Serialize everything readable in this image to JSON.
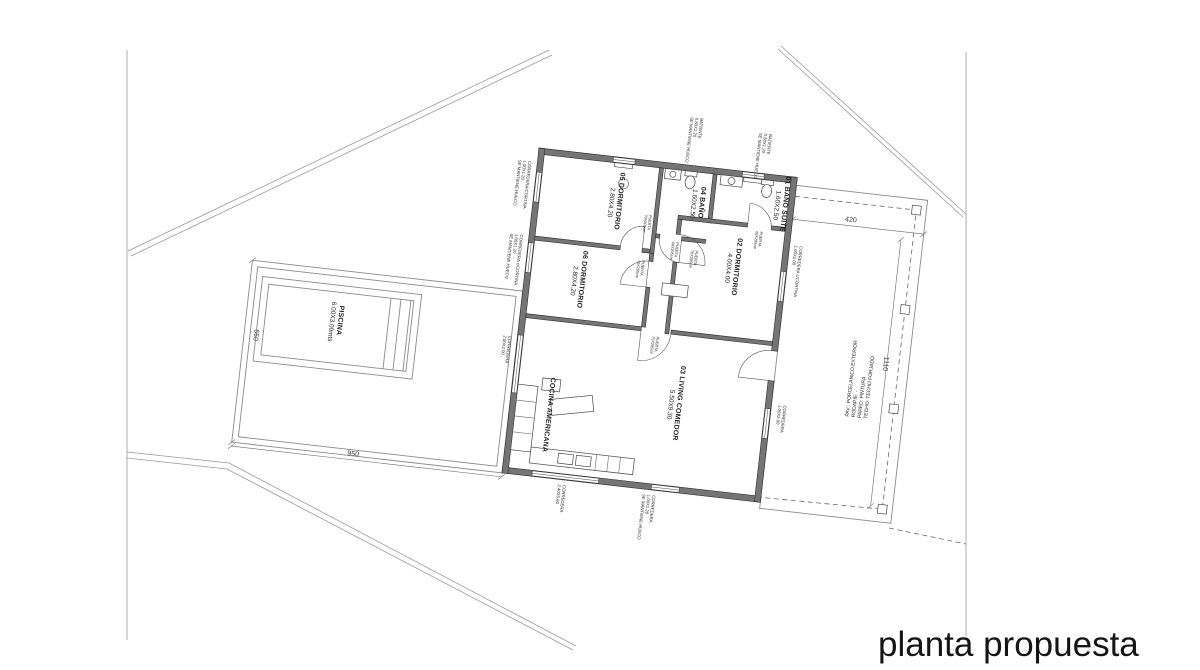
{
  "page_title": "planta propuesta",
  "rooms": [
    {
      "name": "05 DORMITORIO",
      "dims": "2.80X4.20"
    },
    {
      "name": "06 DORMITORIO",
      "dims": "2.80X4.20"
    },
    {
      "name": "04 BAÑO",
      "dims": "1.60X2.50"
    },
    {
      "name": "01 BAÑO SUITE",
      "dims": "1.60X2.50"
    },
    {
      "name": "02 DORMITORIO",
      "dims": "4.00X4.00"
    },
    {
      "name": "03 LIVING COMEDOR",
      "dims": "5.50X9.30"
    },
    {
      "name": "COCINA AMERICANA",
      "dims": ""
    },
    {
      "name": "PISCINA",
      "dims": "6.00X3.00mts"
    }
  ],
  "dimensions": {
    "terrace_width": "420",
    "terrace_length": "1110",
    "parcel_bottom": "950",
    "parcel_left": "650"
  },
  "terrace_note": {
    "l1": "PAV : PORCELANICO EXTERIOR",
    "l2": "RODAPIE: -",
    "l3": "PARED: PINTURA",
    "l4": "TECHO: TECHO FORJADO"
  },
  "window_labels": [
    {
      "l1": "CORREDERA/CORTINA",
      "l2": "1.00X1.20",
      "l3": "SE MANTIENE HUECO"
    },
    {
      "l1": "CORREDERA c/CORTINA",
      "l2": "1.00X1.20",
      "l3": "SE MANTIENE HUECO"
    },
    {
      "l1": "CORREDERA",
      "l2": "2.00X2.00",
      "l3": ""
    },
    {
      "l1": "BATIENTE",
      "l2": "0.80X1.20",
      "l3": "SE MANTIENE HUECO"
    },
    {
      "l1": "BATIENTE",
      "l2": "0.80X1.20",
      "l3": "SE MANTIENE HUECO"
    },
    {
      "l1": "CORREDERA c/CORTINA",
      "l2": "1.00X2.00",
      "l3": ""
    },
    {
      "l1": "CORREDERA",
      "l2": "1.00X2.00",
      "l3": ""
    },
    {
      "l1": "CORREDERA",
      "l2": "2.40X0.60",
      "l3": ""
    },
    {
      "l1": "CORREDERA",
      "l2": "1.00X1.20",
      "l3": "SE MANTIENE HUECO"
    }
  ],
  "door_labels": [
    {
      "label": "PUERTA",
      "size": "70X205cm"
    },
    {
      "label": "PUERTA",
      "size": "60X205cm"
    },
    {
      "label": "PUERTA",
      "size": "70X205cm"
    },
    {
      "label": "PUERTA",
      "size": "60X205cm"
    },
    {
      "label": "PUERTA",
      "size": "70X205cm"
    },
    {
      "label": "PUERTA",
      "size": "75X205cm"
    }
  ],
  "colors": {
    "wall": "#757575",
    "line": "#6a6a6a",
    "text": "#1f1f1f"
  }
}
